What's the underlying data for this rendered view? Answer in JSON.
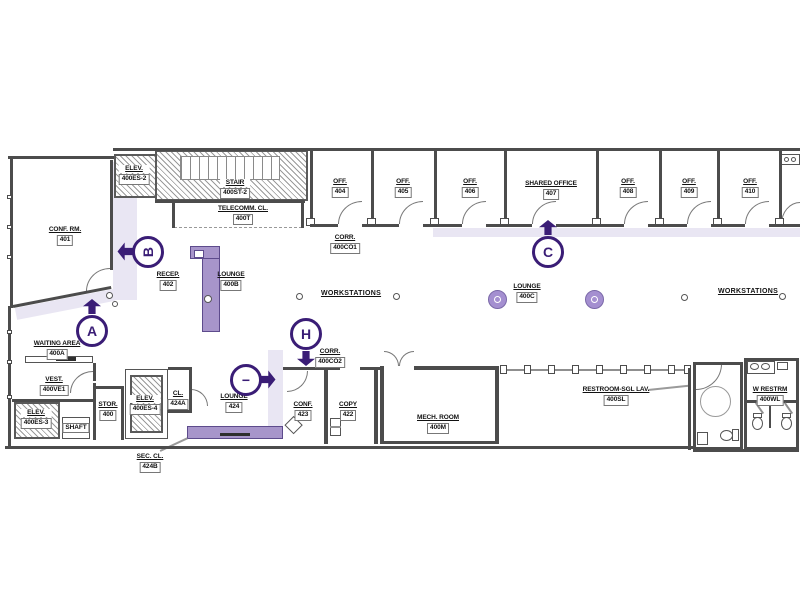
{
  "colors": {
    "marker_purple": "#3a1d76",
    "furniture_purple": "#a795ca",
    "corridor_highlight": "#e9e6f3",
    "wall_gray": "#4c4c4c"
  },
  "rooms": {
    "conf401": {
      "name": "CONF. RM.",
      "num": "401"
    },
    "elev2": {
      "name": "ELEV.",
      "num": "400ES-2"
    },
    "stair": {
      "name": "STAIR",
      "num": "400ST-2"
    },
    "telecomm": {
      "name": "TELECOMM. CL.",
      "num": "400T"
    },
    "corr1": {
      "name": "CORR.",
      "num": "400CO1"
    },
    "recep": {
      "name": "RECEP.",
      "num": "402"
    },
    "loungeB": {
      "name": "LOUNGE",
      "num": "400B"
    },
    "off404": {
      "name": "OFF.",
      "num": "404"
    },
    "off405": {
      "name": "OFF.",
      "num": "405"
    },
    "off406": {
      "name": "OFF.",
      "num": "406"
    },
    "shared407": {
      "name": "SHARED OFFICE",
      "num": "407"
    },
    "off408": {
      "name": "OFF.",
      "num": "408"
    },
    "off409": {
      "name": "OFF.",
      "num": "409"
    },
    "off410": {
      "name": "OFF.",
      "num": "410"
    },
    "loungeC": {
      "name": "LOUNGE",
      "num": "400C"
    },
    "waiting": {
      "name": "WAITING AREA",
      "num": "400A"
    },
    "vest": {
      "name": "VEST.",
      "num": "400VE1"
    },
    "elev3": {
      "name": "ELEV.",
      "num": "400ES-3"
    },
    "shaft": {
      "name": "SHAFT"
    },
    "stor": {
      "name": "STOR.",
      "num": "400"
    },
    "elev4": {
      "name": "ELEV.",
      "num": "400ES-4"
    },
    "cl424a": {
      "name": "CL.",
      "num": "424A"
    },
    "secCl": {
      "name": "SEC. CL.",
      "num": "424B"
    },
    "lounge424": {
      "name": "LOUNGE",
      "num": "424"
    },
    "corr2": {
      "name": "CORR.",
      "num": "400CO2"
    },
    "conf423": {
      "name": "CONF.",
      "num": "423"
    },
    "copy422": {
      "name": "COPY",
      "num": "422"
    },
    "mech": {
      "name": "MECH. ROOM",
      "num": "400M"
    },
    "restroomSgl": {
      "name": "RESTROOM-SGL LAV.",
      "num": "400SL"
    },
    "wRestrm": {
      "name": "W RESTRM",
      "num": "400WL"
    }
  },
  "annotations": {
    "workstations_left": "WORKSTATIONS",
    "workstations_right": "WORKSTATIONS"
  },
  "markers": {
    "a": "A",
    "b": "B",
    "c": "C",
    "h": "H",
    "tour": "−"
  }
}
